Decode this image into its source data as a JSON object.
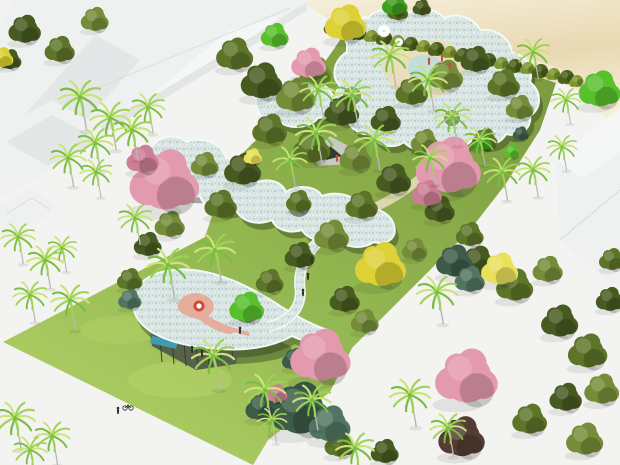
{
  "meta": {
    "description": "Aerial 3D rendering of a tropical landscape design model: serpentine speckled-blue canopy pavilions winding through palm trees, flowering pink and yellow trees, a lawn site between white building massing on the left/right, a hedge row and sandy beach strip at the top right, and tiny human figures.",
    "image_kind": "architectural-rendering",
    "visible_text": ""
  },
  "palette": {
    "ground": "#f3f3f1",
    "beach": "#e9d9b2",
    "beach_light": "#f5eed9",
    "lawn_light": "#b6d46a",
    "lawn": "#94b851",
    "lawn_dark": "#7d9c40",
    "canopy": "#d8e5e2",
    "canopy_dot": "#a6c2bf",
    "canopy_rim": "#f4f8f7",
    "canopy_shadow": "rgba(44,60,30,0.42)",
    "hole_shade": "rgba(58,76,38,0.55)",
    "building": "#eff1f0",
    "building_face": "#e2e6e5",
    "building_light": "#f5f7f6",
    "building_line": "#d9dedd",
    "olive_dark": "#475a20",
    "olive": "#5d7529",
    "olive_light": "#758d39",
    "palm_dark": "#79bd41",
    "palm_mid": "#9cd355",
    "palm_light": "#cbe478",
    "trunk": "#b5bab0",
    "pink": "#e49aae",
    "pink_dark": "#cd7d95",
    "yellow": "#ddd135",
    "yellow_light": "#e9e05c",
    "teal_bush": "#3c5b48",
    "teal_bush_light": "#527561",
    "bright_green": "#57c02c",
    "bright_green_dark": "#3f9e1e",
    "maroon": "#533c34",
    "hedge_dark": "#4b611c",
    "hedge_light": "#7e962e",
    "sand_path": "#e9dfbf",
    "pool": "#c3ddda",
    "pool_deep": "#3f9cae",
    "glass": "#57604a",
    "glass_dark": "#343c2b",
    "people": "#2e322c",
    "red_accent": "#cd4a37",
    "salmon": "#e5ad9c",
    "white": "#ffffff"
  },
  "objects": {
    "palms": [
      [
        80,
        97,
        1
      ],
      [
        110,
        118,
        0.95
      ],
      [
        95,
        143,
        0.85
      ],
      [
        132,
        130,
        0.9
      ],
      [
        148,
        107,
        0.8
      ],
      [
        68,
        158,
        0.85
      ],
      [
        96,
        172,
        0.75
      ],
      [
        135,
        218,
        0.8
      ],
      [
        18,
        237,
        0.8
      ],
      [
        45,
        260,
        0.85
      ],
      [
        30,
        295,
        0.8
      ],
      [
        70,
        300,
        0.9
      ],
      [
        62,
        248,
        0.7
      ],
      [
        15,
        418,
        0.95
      ],
      [
        52,
        436,
        0.85
      ],
      [
        30,
        450,
        0.8
      ],
      [
        168,
        265,
        1
      ],
      [
        215,
        250,
        0.95
      ],
      [
        213,
        356,
        1
      ],
      [
        265,
        390,
        0.95
      ],
      [
        312,
        400,
        0.9
      ],
      [
        272,
        420,
        0.7
      ],
      [
        355,
        448,
        0.9
      ],
      [
        410,
        395,
        0.95
      ],
      [
        437,
        292,
        0.95
      ],
      [
        448,
        428,
        0.85
      ],
      [
        390,
        56,
        0.9
      ],
      [
        428,
        80,
        0.9
      ],
      [
        352,
        95,
        0.9
      ],
      [
        316,
        133,
        0.95
      ],
      [
        374,
        140,
        0.9
      ],
      [
        452,
        117,
        0.85
      ],
      [
        480,
        140,
        0.75
      ],
      [
        430,
        158,
        0.8
      ],
      [
        318,
        90,
        0.85
      ],
      [
        533,
        52,
        0.8
      ],
      [
        566,
        100,
        0.7
      ],
      [
        502,
        172,
        0.85
      ],
      [
        533,
        170,
        0.8
      ],
      [
        562,
        147,
        0.7
      ],
      [
        290,
        160,
        0.8
      ]
    ],
    "olive_trees": [
      [
        25,
        30,
        14,
        0
      ],
      [
        60,
        50,
        13,
        1
      ],
      [
        95,
        20,
        12,
        2
      ],
      [
        10,
        60,
        10,
        0
      ],
      [
        235,
        55,
        16,
        1
      ],
      [
        262,
        82,
        18,
        0
      ],
      [
        296,
        96,
        17,
        2
      ],
      [
        270,
        130,
        15,
        1
      ],
      [
        243,
        170,
        16,
        0
      ],
      [
        221,
        205,
        14,
        1
      ],
      [
        316,
        72,
        14,
        2
      ],
      [
        342,
        112,
        15,
        0
      ],
      [
        312,
        148,
        16,
        1
      ],
      [
        356,
        158,
        14,
        2
      ],
      [
        386,
        120,
        13,
        0
      ],
      [
        412,
        92,
        14,
        1
      ],
      [
        446,
        76,
        15,
        2
      ],
      [
        476,
        60,
        13,
        0
      ],
      [
        504,
        84,
        14,
        1
      ],
      [
        520,
        108,
        12,
        2
      ],
      [
        394,
        180,
        15,
        0
      ],
      [
        362,
        206,
        14,
        1
      ],
      [
        332,
        236,
        15,
        2
      ],
      [
        300,
        256,
        13,
        0
      ],
      [
        270,
        282,
        12,
        1
      ],
      [
        425,
        142,
        12,
        2
      ],
      [
        455,
        160,
        12,
        0
      ],
      [
        485,
        140,
        11,
        1
      ],
      [
        170,
        225,
        13,
        2
      ],
      [
        148,
        245,
        12,
        0
      ],
      [
        180,
        185,
        13,
        1
      ],
      [
        205,
        165,
        12,
        2
      ],
      [
        440,
        210,
        13,
        0
      ],
      [
        470,
        235,
        12,
        1
      ],
      [
        415,
        250,
        11,
        2
      ],
      [
        299,
        202,
        11,
        1
      ],
      [
        130,
        280,
        11,
        1
      ],
      [
        345,
        300,
        13,
        0
      ],
      [
        365,
        322,
        12,
        2
      ],
      [
        398,
        12,
        9,
        1
      ],
      [
        422,
        8,
        8,
        0
      ],
      [
        478,
        262,
        15,
        0
      ],
      [
        515,
        286,
        16,
        1
      ],
      [
        548,
        270,
        13,
        2
      ],
      [
        560,
        322,
        16,
        0
      ],
      [
        588,
        352,
        17,
        1
      ],
      [
        602,
        390,
        15,
        2
      ],
      [
        566,
        398,
        14,
        0
      ],
      [
        530,
        420,
        15,
        1
      ],
      [
        585,
        440,
        16,
        2
      ],
      [
        610,
        300,
        12,
        0
      ],
      [
        612,
        260,
        11,
        1
      ],
      [
        340,
        445,
        13,
        1
      ],
      [
        385,
        452,
        12,
        0
      ]
    ],
    "pink_trees": [
      [
        165,
        182,
        30,
        0
      ],
      [
        143,
        160,
        14,
        1
      ],
      [
        309,
        64,
        15,
        0
      ],
      [
        449,
        167,
        28,
        0
      ],
      [
        427,
        194,
        13,
        1
      ],
      [
        321,
        357,
        26,
        0
      ],
      [
        467,
        378,
        27,
        0
      ],
      [
        277,
        394,
        9,
        1
      ]
    ],
    "yellow_trees": [
      [
        346,
        24,
        18,
        0
      ],
      [
        381,
        266,
        22,
        0
      ],
      [
        500,
        270,
        16,
        1
      ],
      [
        253,
        157,
        8,
        1
      ],
      [
        2,
        58,
        10,
        0
      ]
    ],
    "teal_bushes": [
      [
        300,
        410,
        26,
        0
      ],
      [
        330,
        425,
        18,
        1
      ],
      [
        262,
        408,
        14,
        0
      ],
      [
        455,
        262,
        16,
        0
      ],
      [
        470,
        280,
        13,
        1
      ],
      [
        295,
        360,
        11,
        0
      ],
      [
        521,
        134,
        7,
        0
      ],
      [
        130,
        300,
        10,
        1
      ]
    ],
    "bright_trees": [
      [
        600,
        90,
        18,
        0
      ],
      [
        483,
        143,
        8,
        1
      ],
      [
        512,
        152,
        7,
        0
      ],
      [
        247,
        308,
        15,
        0
      ],
      [
        395,
        5,
        11,
        1
      ],
      [
        275,
        36,
        12,
        0
      ]
    ],
    "maroon_trees": [
      [
        462,
        438,
        20,
        0
      ]
    ],
    "hedge": [
      [
        333,
        27,
        7
      ],
      [
        346,
        31,
        6
      ],
      [
        359,
        33,
        7
      ],
      [
        372,
        36,
        6
      ],
      [
        385,
        38,
        7
      ],
      [
        398,
        41,
        6
      ],
      [
        411,
        44,
        7
      ],
      [
        424,
        46,
        6
      ],
      [
        437,
        49,
        7
      ],
      [
        450,
        52,
        6
      ],
      [
        463,
        55,
        7
      ],
      [
        476,
        57,
        6
      ],
      [
        489,
        60,
        7
      ],
      [
        502,
        63,
        6
      ],
      [
        515,
        66,
        7
      ],
      [
        528,
        68,
        6
      ],
      [
        541,
        71,
        7
      ],
      [
        554,
        74,
        6
      ],
      [
        567,
        77,
        7
      ],
      [
        577,
        81,
        6
      ]
    ],
    "people_dark": [
      [
        240,
        331
      ],
      [
        303,
        293
      ],
      [
        308,
        277
      ],
      [
        312,
        261
      ],
      [
        192,
        350
      ],
      [
        202,
        354
      ],
      [
        118,
        411
      ]
    ],
    "people_red": [
      [
        429,
        62
      ],
      [
        442,
        59
      ],
      [
        450,
        67
      ],
      [
        337,
        159
      ]
    ],
    "bikes": [
      [
        128,
        406
      ]
    ],
    "umbrellas": [
      [
        384,
        31,
        6
      ],
      [
        399,
        42,
        4
      ]
    ]
  }
}
